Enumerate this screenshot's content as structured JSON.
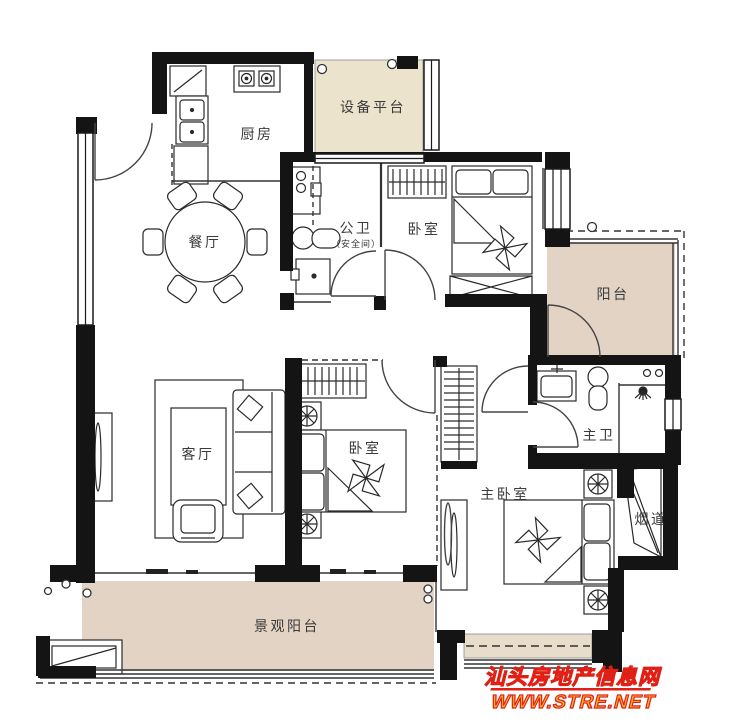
{
  "title": "apartment-floor-plan",
  "rooms": {
    "kitchen": "厨房",
    "equipment_platform": "设备平台",
    "dining": "餐厅",
    "public_bath": "公卫",
    "public_bath_note": "（安全间）",
    "bedroom_top": "卧室",
    "balcony_right": "阳台",
    "living": "客厅",
    "bedroom_mid": "卧室",
    "master_bath": "主卫",
    "master_bedroom": "主卧室",
    "flue": "烟道",
    "scenic_balcony": "景观阳台"
  },
  "watermark": {
    "line1": "汕头房地产信息网",
    "line2": "WWW.STRE.NET"
  },
  "colors": {
    "wall": "#141414",
    "line": "#333333",
    "balcony_fill": "#e2d3c5",
    "platform_fill": "#ece3cd",
    "bay_fill": "#e8dcca",
    "watermark_red": "#e02015",
    "watermark_yellow": "#f8b02c"
  }
}
